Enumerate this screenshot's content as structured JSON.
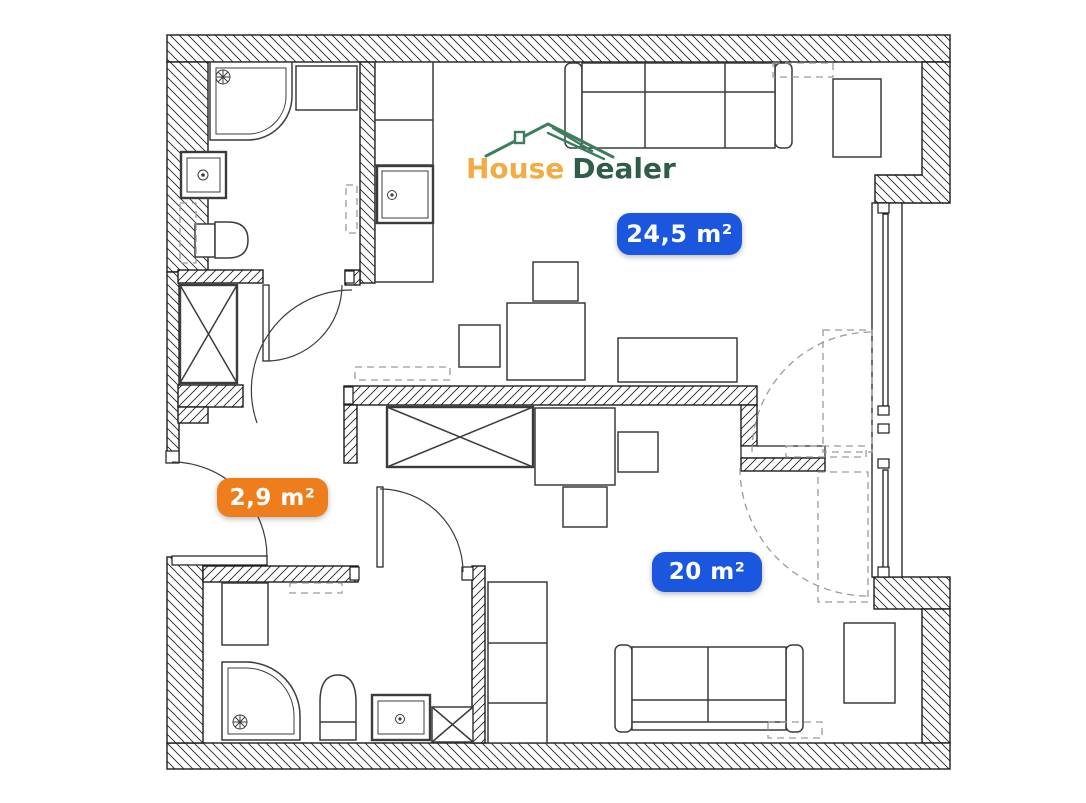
{
  "page": {
    "background": "#ffffff"
  },
  "logo": {
    "brand_word_1": "House",
    "brand_word_2": "Dealer",
    "icon": "house-roof-icon"
  },
  "badges": [
    {
      "label": "24,5 m²",
      "style": "blue"
    },
    {
      "label": "2,9 m²",
      "style": "orange"
    },
    {
      "label": "20 m²",
      "style": "blue"
    }
  ],
  "colors": {
    "badge-blue": "#1a57de",
    "badge-orange": "#ee7d1b",
    "logo-amber": "#f3ab44",
    "logo-green": "#2f5d49",
    "roof-green": "#3e7d5d",
    "wall-line": "#1c1c1c",
    "furniture-line": "#3c3c3c",
    "dash-line": "#9b9b9b"
  },
  "plan": {
    "fixtures": [
      "corner-shower",
      "washing-machine",
      "washbasin",
      "toilet",
      "kitchen-counter",
      "kitchen-sink",
      "sofa",
      "armchair",
      "table",
      "chair",
      "wardrobe",
      "desk",
      "cabinet",
      "window",
      "door",
      "balcony-door"
    ]
  }
}
